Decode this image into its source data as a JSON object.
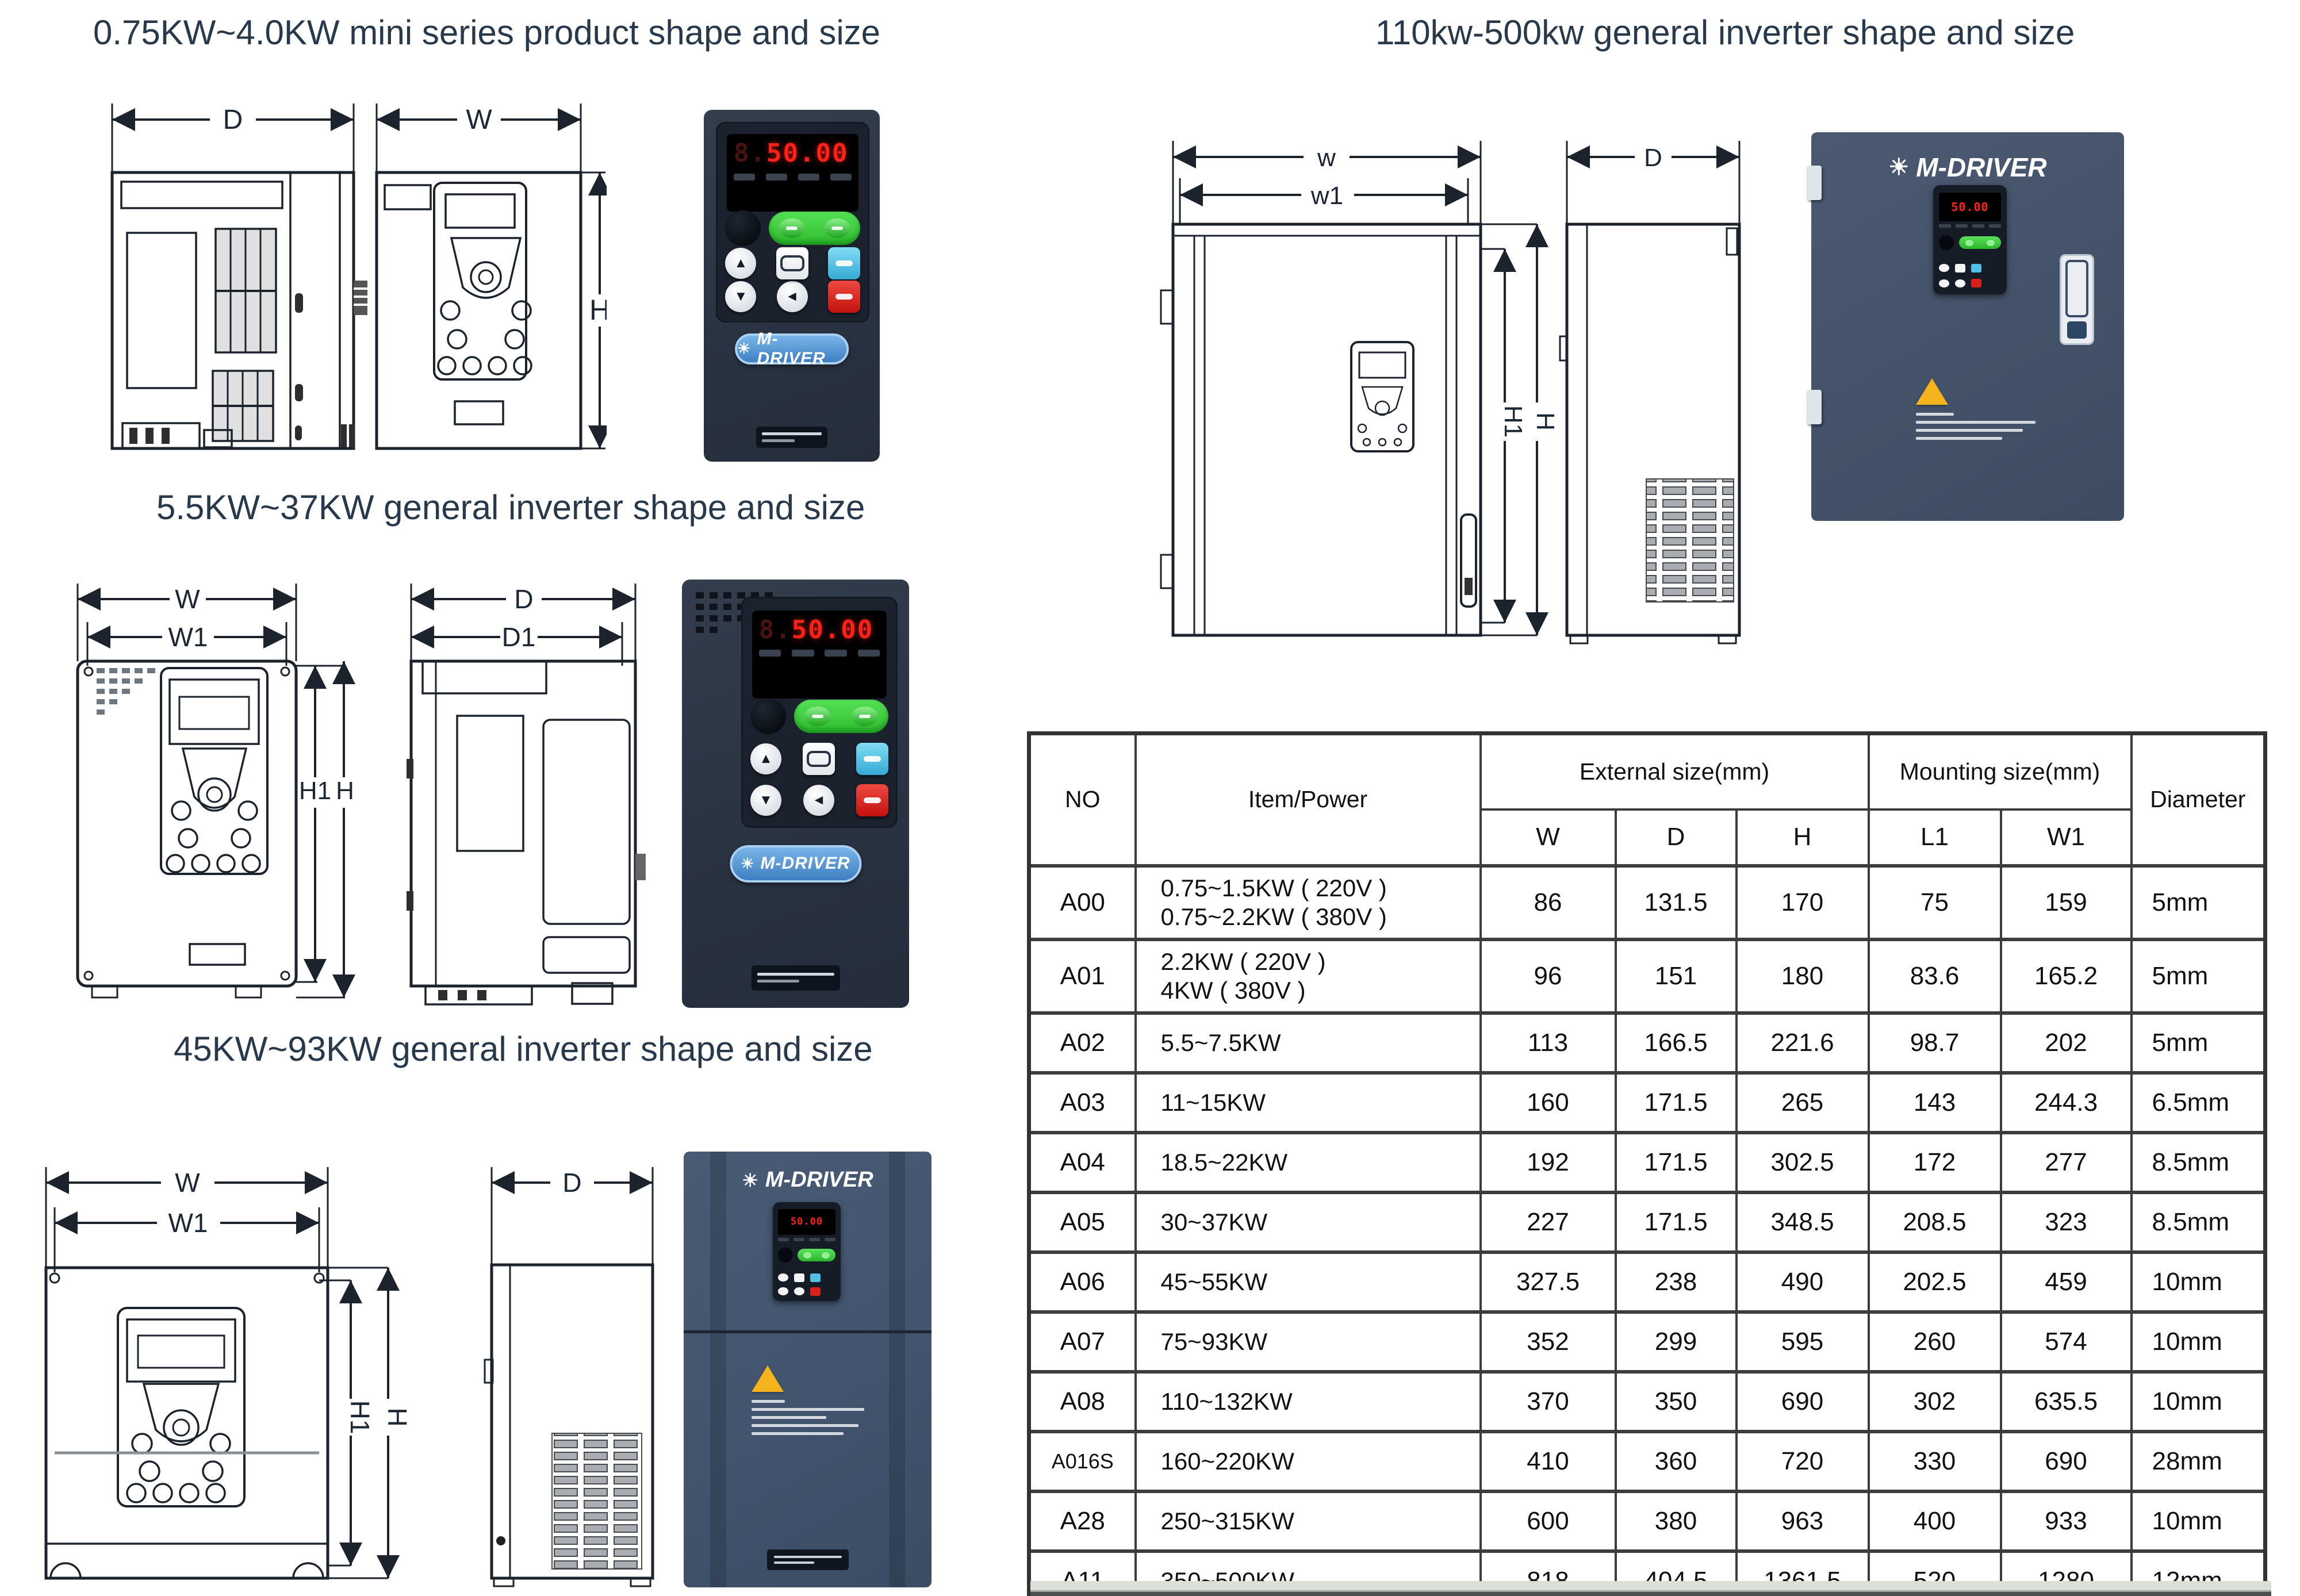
{
  "titles": {
    "mini": "0.75KW~4.0KW mini series product shape and size",
    "mid": "5.5KW~37KW general inverter shape and size",
    "large": "45KW~93KW general inverter shape and size",
    "big": "110kw-500kw general inverter shape and size"
  },
  "brand": {
    "logo": "M-DRIVER",
    "display_ghost": "8.",
    "display_value": "50.00"
  },
  "icons": {
    "sun": "☀",
    "up": "▲",
    "down": "▼",
    "left": "◄"
  },
  "dims": {
    "D": "D",
    "W": "W",
    "H": "H",
    "W1": "W1",
    "H1": "H1",
    "D1": "D1",
    "w": "w",
    "w1": "w1"
  },
  "table": {
    "col_no": "NO",
    "col_item": "Item/Power",
    "col_external": "External size(mm)",
    "col_mounting": "Mounting size(mm)",
    "col_diameter": "Diameter",
    "sub_cols": [
      "W",
      "D",
      "H",
      "L1",
      "W1"
    ],
    "rows": [
      {
        "no": "A00",
        "item": [
          "0.75~1.5KW ( 220V )",
          "0.75~2.2KW ( 380V )"
        ],
        "w": "86",
        "d": "131.5",
        "h": "170",
        "l1": "75",
        "w1": "159",
        "dia": "5mm"
      },
      {
        "no": "A01",
        "item": [
          "2.2KW ( 220V )",
          "4KW ( 380V )"
        ],
        "w": "96",
        "d": "151",
        "h": "180",
        "l1": "83.6",
        "w1": "165.2",
        "dia": "5mm"
      },
      {
        "no": "A02",
        "item": [
          "5.5~7.5KW"
        ],
        "w": "113",
        "d": "166.5",
        "h": "221.6",
        "l1": "98.7",
        "w1": "202",
        "dia": "5mm"
      },
      {
        "no": "A03",
        "item": [
          "11~15KW"
        ],
        "w": "160",
        "d": "171.5",
        "h": "265",
        "l1": "143",
        "w1": "244.3",
        "dia": "6.5mm"
      },
      {
        "no": "A04",
        "item": [
          "18.5~22KW"
        ],
        "w": "192",
        "d": "171.5",
        "h": "302.5",
        "l1": "172",
        "w1": "277",
        "dia": "8.5mm"
      },
      {
        "no": "A05",
        "item": [
          "30~37KW"
        ],
        "w": "227",
        "d": "171.5",
        "h": "348.5",
        "l1": "208.5",
        "w1": "323",
        "dia": "8.5mm"
      },
      {
        "no": "A06",
        "item": [
          "45~55KW"
        ],
        "w": "327.5",
        "d": "238",
        "h": "490",
        "l1": "202.5",
        "w1": "459",
        "dia": "10mm"
      },
      {
        "no": "A07",
        "item": [
          "75~93KW"
        ],
        "w": "352",
        "d": "299",
        "h": "595",
        "l1": "260",
        "w1": "574",
        "dia": "10mm"
      },
      {
        "no": "A08",
        "item": [
          "110~132KW"
        ],
        "w": "370",
        "d": "350",
        "h": "690",
        "l1": "302",
        "w1": "635.5",
        "dia": "10mm"
      },
      {
        "no": "A016S",
        "item": [
          "160~220KW"
        ],
        "w": "410",
        "d": "360",
        "h": "720",
        "l1": "330",
        "w1": "690",
        "dia": "28mm"
      },
      {
        "no": "A28",
        "item": [
          "250~315KW"
        ],
        "w": "600",
        "d": "380",
        "h": "963",
        "l1": "400",
        "w1": "933",
        "dia": "10mm"
      },
      {
        "no": "A11",
        "item": [
          "350~500KW"
        ],
        "w": "818",
        "d": "404.5",
        "h": "1361.5",
        "l1": "520",
        "w1": "1280",
        "dia": "12mm"
      }
    ]
  },
  "colors": {
    "title": "#27394b",
    "body_dark": "#2a3342",
    "cabinet_slate": "#45536a",
    "badge_blue": "#4a8fd0",
    "display_red": "#ff2017",
    "run_green": "#3fcf3f",
    "stop_red": "#d8201c",
    "aux_blue": "#52c0e6",
    "warn_yellow": "#f5b41d"
  }
}
